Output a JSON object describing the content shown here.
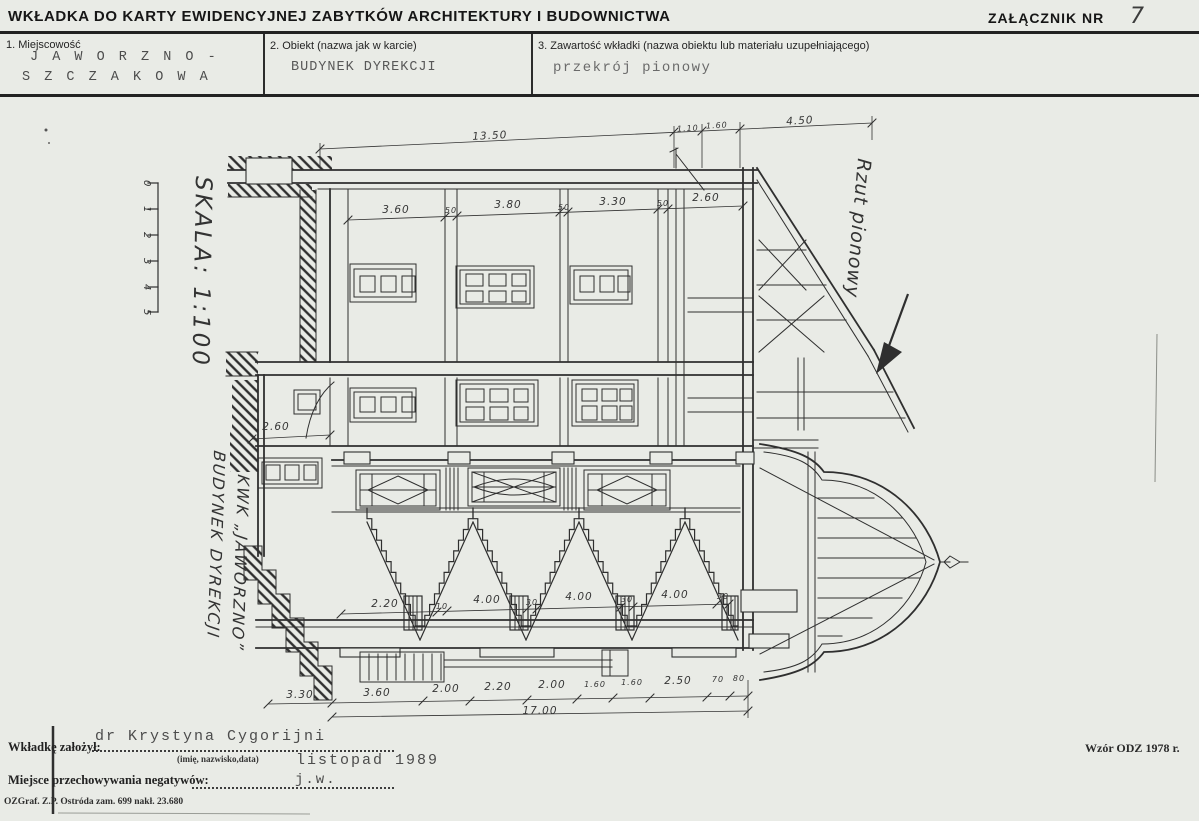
{
  "page": {
    "title": "WKŁADKA DO KARTY EWIDENCYJNEJ ZABYTKÓW ARCHITEKTURY I BUDOWNICTWA",
    "attachment_label": "ZAŁĄCZNIK NR",
    "attachment_number": "7"
  },
  "fields": {
    "f1_label": "1. Miejscowość",
    "f1_value_line1": "J A W O R Z N O -",
    "f1_value_line2": "S Z C Z A K O W A",
    "f2_label": "2. Obiekt (nazwa jak w karcie)",
    "f2_value": "BUDYNEK DYREKCJI",
    "f3_label": "3. Zawartość wkładki (nazwa obiektu lub materiału uzupełniającego)",
    "f3_value": "przekrój pionowy"
  },
  "drawing": {
    "scale_label": "SKALA: 1:100",
    "scale_ticks": [
      "0",
      "1",
      "2",
      "3",
      "4",
      "5"
    ],
    "side_title_line1": "BUDYNEK DYREKCJI",
    "side_title_line2": "KWK „JAWORZNO”",
    "annotation": "Rzut pionowy",
    "dims_top": [
      "13.50",
      "1.10",
      "1.60",
      "4.50"
    ],
    "dims_upper": [
      "3.60",
      "50",
      "3.80",
      "50",
      "3.30",
      "50",
      "2.60"
    ],
    "dim_left": "2.60",
    "dims_mid": [
      "2.20",
      "10",
      "4.00",
      "30",
      "4.00",
      "30",
      "4.00",
      "30"
    ],
    "dims_bottom": [
      "3.30",
      "3.60",
      "2.00",
      "2.20",
      "2.00",
      "1.60",
      "1.60",
      "2.50",
      "70",
      "80"
    ],
    "dim_total": "17.00"
  },
  "footer": {
    "founder_label": "Wkładkę założył:",
    "founder_value": "dr Krystyna Cygorijni",
    "founder_hint": "(imię, nazwisko,data)",
    "founder_date": "listopad 1989",
    "negatives_label": "Miejsce przechowywania negatywów:",
    "negatives_value": "j.w.",
    "print_info": "OZGraf. Z.P. Ostróda zam. 699 nakł. 23.680",
    "form_info": "Wzór ODZ 1978 r."
  }
}
